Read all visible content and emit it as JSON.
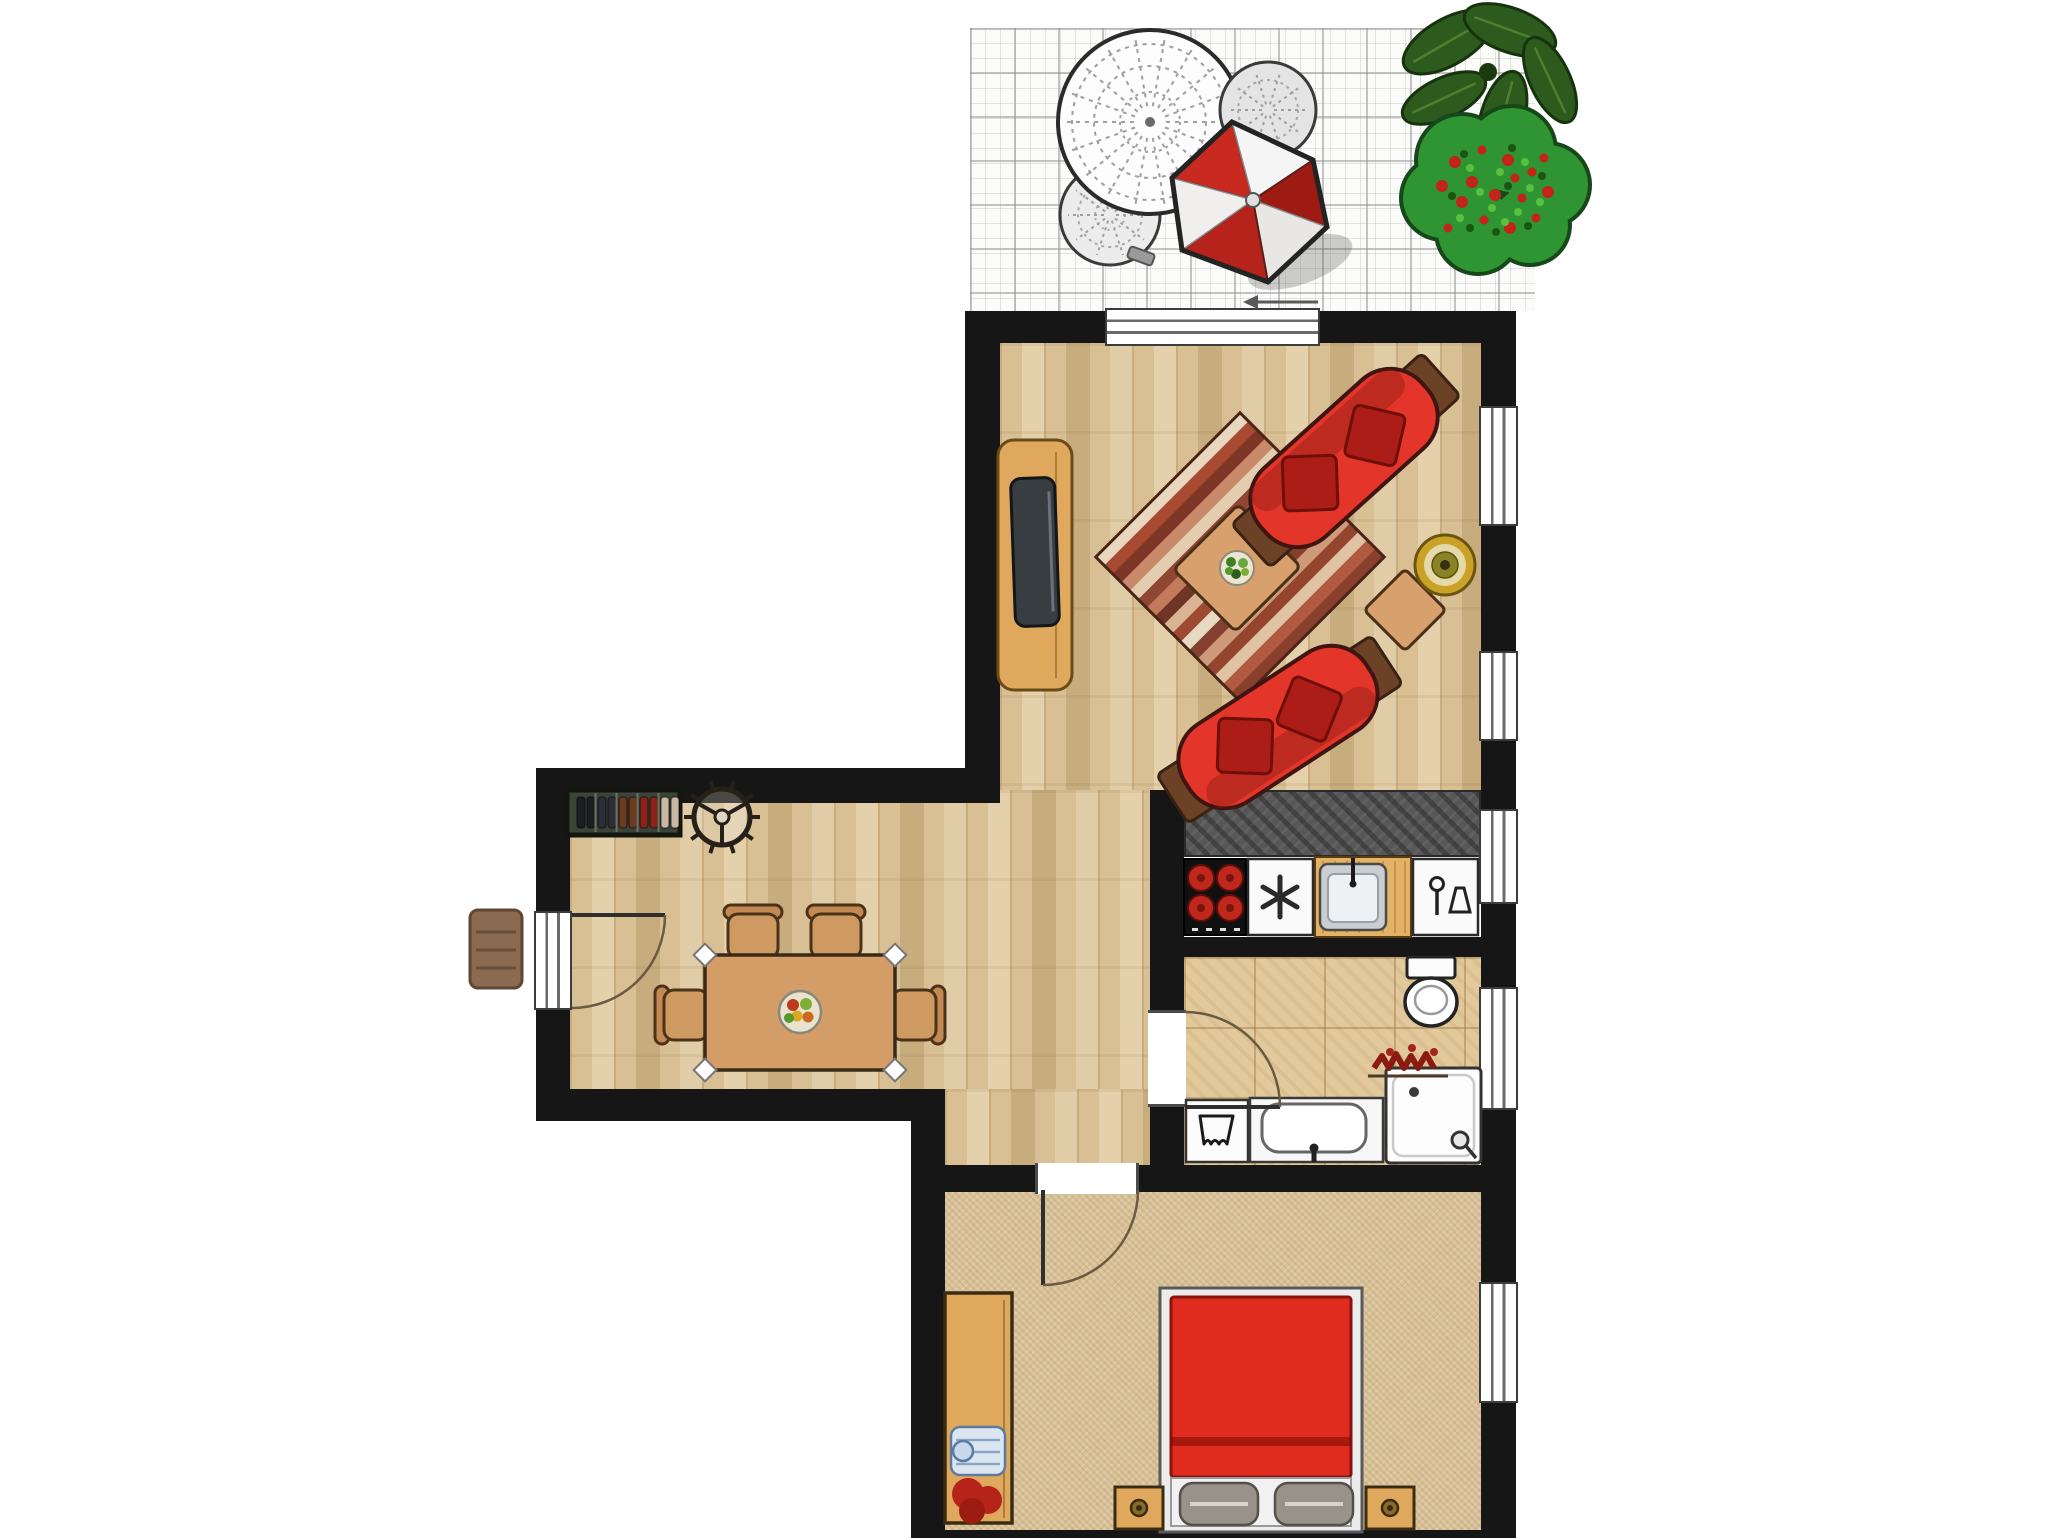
{
  "title": "apartment-floor-plan",
  "colors": {
    "background": "#ffffff",
    "wall": "#161616",
    "parquet": "#d8c094",
    "carpet": "#d9c197",
    "tile": "#e2c99c",
    "paving": "#fbfbfa",
    "counter_granite": "#575757",
    "sofa": "#e4352b",
    "pillow": "#ad1d17",
    "bed": "#e02b1f",
    "wood": "#e0a85c",
    "table_wood": "#d49c66",
    "umbrella_red": "#c92a20",
    "umbrella_white": "#f5f5f5",
    "plant_green": "#2d5a1d",
    "bush_green": "#2f9432",
    "flower_red": "#c22418",
    "pot_gold": "#c9a227"
  },
  "terrace": {
    "floor": "stone-paving",
    "items": [
      "lace-table",
      "lace-chair",
      "lace-chair",
      "parasol",
      "leaf-plant",
      "flower-bush"
    ]
  },
  "living_room": {
    "floor": "parquet",
    "windows": [
      "window",
      "window"
    ],
    "doors": [
      "terrace-sliding-door"
    ],
    "furniture": [
      "tv-cabinet",
      "tv",
      "striped-rug",
      "coffee-table",
      "table-plant",
      "sofa",
      "sofa",
      "side-table",
      "potted-plant"
    ]
  },
  "kitchen": {
    "counter": "granite",
    "windows": [
      "window"
    ],
    "appliances": [
      "cooktop",
      "freezer",
      "wood-counter",
      "sink",
      "dishwasher"
    ]
  },
  "hallway": {
    "furniture": [
      "shoe-rack",
      "coat-rack",
      "doormat"
    ],
    "doors": [
      "entrance-door"
    ]
  },
  "dining_area": {
    "floor": "parquet",
    "furniture": [
      "dining-table",
      "chair",
      "chair",
      "chair",
      "chair",
      "fruit-bowl"
    ]
  },
  "bathroom": {
    "floor": "tile",
    "windows": [
      "window"
    ],
    "doors": [
      "bathroom-door"
    ],
    "fixtures": [
      "toilet",
      "washing-machine",
      "washbasin",
      "shower",
      "plant"
    ]
  },
  "bedroom": {
    "floor": "carpet",
    "windows": [
      "window"
    ],
    "doors": [
      "bedroom-door"
    ],
    "furniture": [
      "wardrobe",
      "double-bed",
      "pillow",
      "pillow",
      "nightstand",
      "nightstand"
    ]
  },
  "rug": {
    "stripe_colors": [
      "#e8d8c0",
      "#a64a32",
      "#7d3526",
      "#c98a6a",
      "#e3cdb0",
      "#8f4632",
      "#c4795a",
      "#6f3526",
      "#d8b494",
      "#9e4a33",
      "#e8d9c2",
      "#83402e",
      "#ce9a7a",
      "#94452f",
      "#dfc3a4",
      "#b05a3f",
      "#8a3e2c"
    ]
  },
  "shoe_rack": {
    "pair_colors": [
      "#1d1d24",
      "#2e2e38",
      "#6e3a20",
      "#8a2418",
      "#c9b9a4"
    ]
  }
}
